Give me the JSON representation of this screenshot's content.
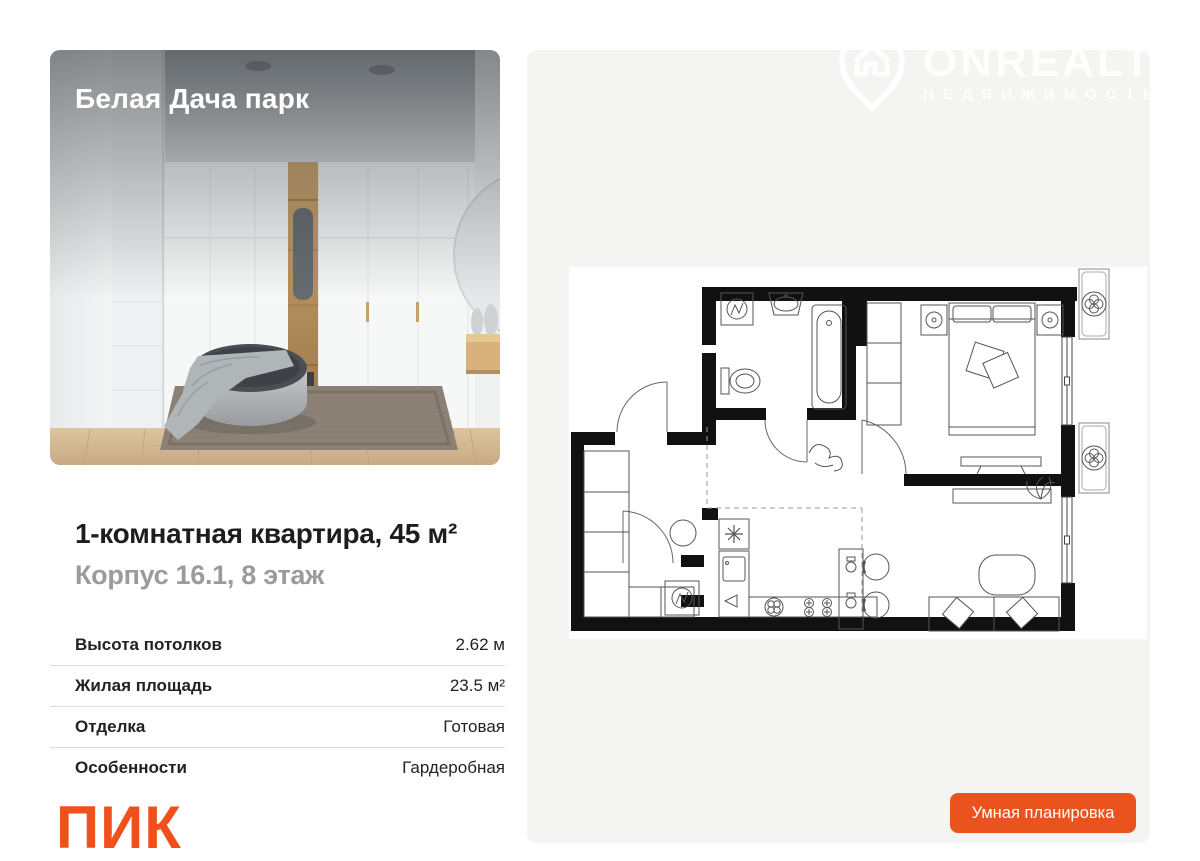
{
  "photo_card": {
    "project_name": "Белая Дача парк"
  },
  "listing": {
    "title": "1-комнатная квартира, 45 м²",
    "subtitle": "Корпус 16.1, 8 этаж",
    "specs": [
      {
        "label": "Высота потолков",
        "value": "2.62 м"
      },
      {
        "label": "Жилая площадь",
        "value": "23.5 м²"
      },
      {
        "label": "Отделка",
        "value": "Готовая"
      },
      {
        "label": "Особенности",
        "value": "Гардеробная"
      }
    ]
  },
  "branding": {
    "developer_logo": "ПИК",
    "logo_color": "#F0511C"
  },
  "watermark": {
    "name": "ONREALT",
    "subtitle": "НЕДВИЖИМОСТЬ"
  },
  "plan_panel": {
    "background": "#F4F4F2",
    "button_label": "Умная планировка",
    "button_color": "#EB531E"
  }
}
